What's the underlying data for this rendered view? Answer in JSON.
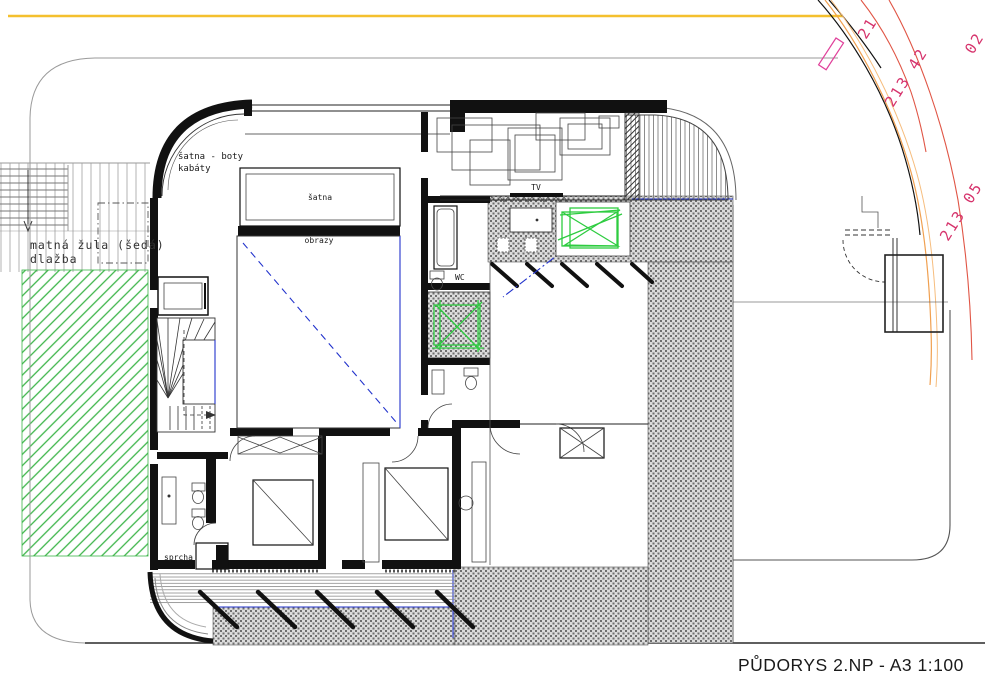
{
  "drawing": {
    "title": "PŮDORYS 2.NP - A3  1:100",
    "labels": {
      "entry_line1": "šatna - boty",
      "entry_line2": "kabáty",
      "closet": "šatna",
      "pictures": "obrazy",
      "tv": "TV",
      "wc": "WC",
      "shower": "sprcha",
      "paving_line1": "matná žula (šedá)",
      "paving_line2": "dlažba"
    },
    "elevations": {
      "contour_a": "213 42",
      "contour_b": "213 05",
      "partial_top": "21",
      "partial_corner": "02"
    },
    "colors": {
      "utility_yellow": "#f4c02e",
      "curb_orange": "#f0a050",
      "contour_red": "#e05545",
      "contour_label_pink": "#d6336c",
      "markup_green": "#2ecc40",
      "lawn_green": "#3db54a",
      "membrane_blue": "#2233cc",
      "wall_black": "#111111"
    }
  }
}
